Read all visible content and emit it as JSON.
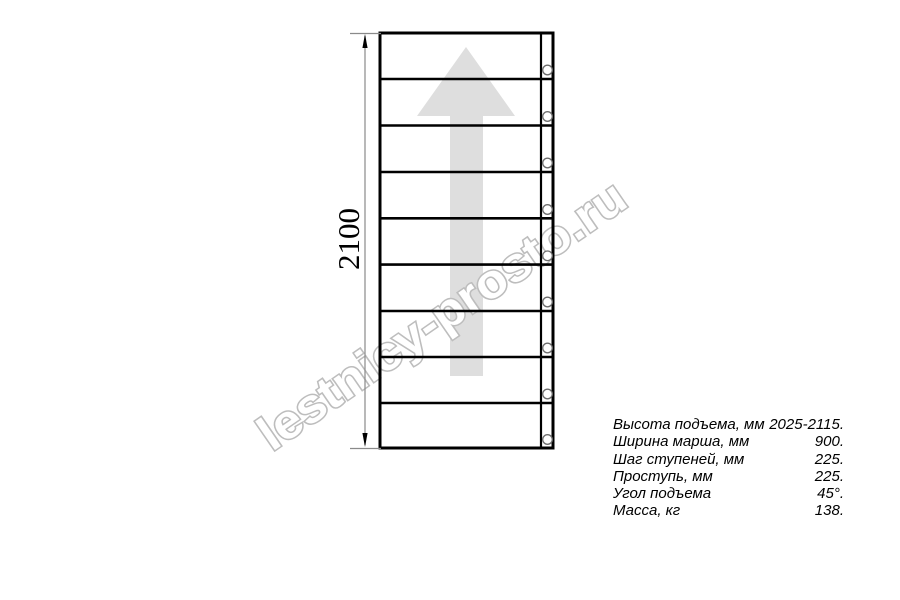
{
  "diagram": {
    "type": "staircase-plan-top-view",
    "dimension_label": "2100",
    "watermark_text": "lestnicy-prosto.ru",
    "steps_count": 9,
    "fastener_count": 9,
    "colors": {
      "line": "#000000",
      "dimension": "#8a8a8a",
      "arrow_fill": "#dedede",
      "watermark_fill": "#ffffff",
      "watermark_stroke": "#bdbdbd",
      "fastener_stroke": "#6e6e6e"
    }
  },
  "specs": {
    "rows": [
      {
        "label": "Высота подъема, мм",
        "value": "2025-2115."
      },
      {
        "label": "Ширина марша, мм",
        "value": "900."
      },
      {
        "label": "Шаг ступеней, мм",
        "value": "225."
      },
      {
        "label": "Проступь, мм",
        "value": "225."
      },
      {
        "label": "Угол подъема",
        "value": "45°."
      },
      {
        "label": "Масса, кг",
        "value": "138."
      }
    ]
  }
}
